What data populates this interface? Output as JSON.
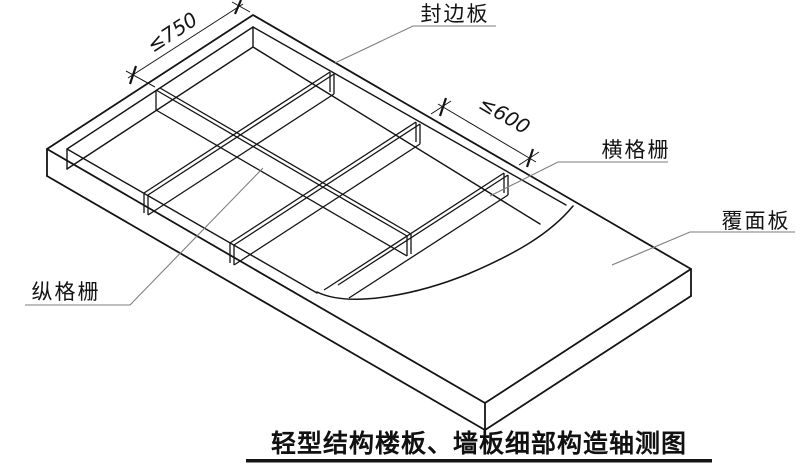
{
  "title": {
    "text": "轻型结构楼板、墙板细部构造轴测图"
  },
  "labels": {
    "edge_board": "封边板",
    "transverse_joist": "横格栅",
    "longitudinal_joist": "纵格栅",
    "cover_panel": "覆面板"
  },
  "dimensions": {
    "longitudinal_joist_spacing": "≤750",
    "transverse_joist_spacing": "≤600"
  },
  "colors": {
    "line": "#141414",
    "leader": "#7e7e7e",
    "background": "#ffffff"
  }
}
